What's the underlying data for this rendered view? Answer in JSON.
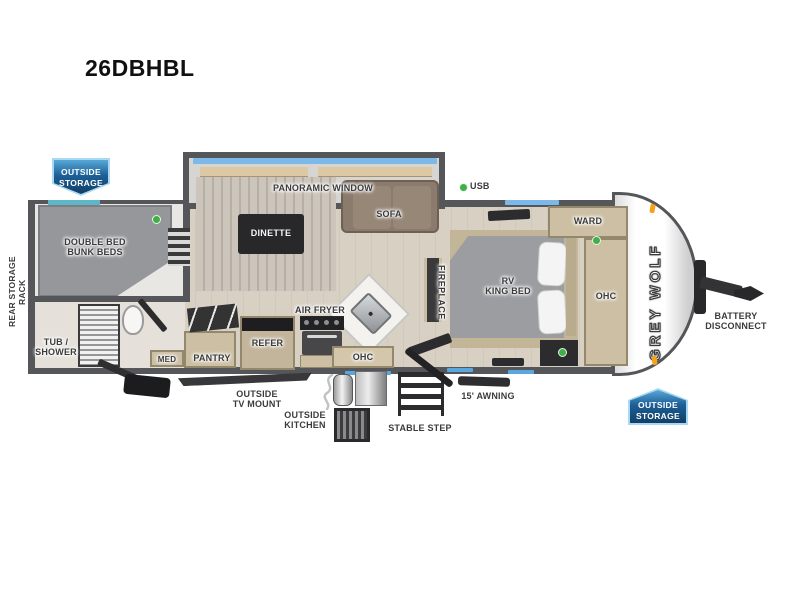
{
  "model": "26DBHBL",
  "brand": "GREY WOLF",
  "colors": {
    "wall": "#55565a",
    "floor": "#d8d0c3",
    "badge_blue": "#1d5f97",
    "window_blue": "#7db9e8",
    "indicator_green": "#3faf46",
    "marker_orange": "#f5a11c",
    "sofa_brown": "#8b7b6c",
    "cabinet_tan": "#ccbfa4"
  },
  "badges": {
    "rear_storage": "OUTSIDE\nSTORAGE",
    "front_storage": "OUTSIDE\nSTORAGE"
  },
  "labels": {
    "rear_storage_rack": "REAR STORAGE RACK",
    "bunk_beds": "DOUBLE BED\nBUNK BEDS",
    "panoramic_window": "PANORAMIC WINDOW",
    "dinette": "DINETTE",
    "sofa": "SOFA",
    "usb": "USB",
    "tub_shower": "TUB /\nSHOWER",
    "med": "MED",
    "pantry": "PANTRY",
    "refer": "REFER",
    "air_fryer": "AIR FRYER",
    "ohc_kitchen": "OHC",
    "fireplace": "FIREPLACE",
    "rv_king_bed": "RV\nKING BED",
    "ward": "WARD",
    "ohc_bedroom": "OHC",
    "outside_tv_mount": "OUTSIDE\nTV MOUNT",
    "outside_kitchen": "OUTSIDE\nKITCHEN",
    "stable_step": "STABLE STEP",
    "awning": "15' AWNING",
    "battery_disconnect": "BATTERY\nDISCONNECT"
  }
}
